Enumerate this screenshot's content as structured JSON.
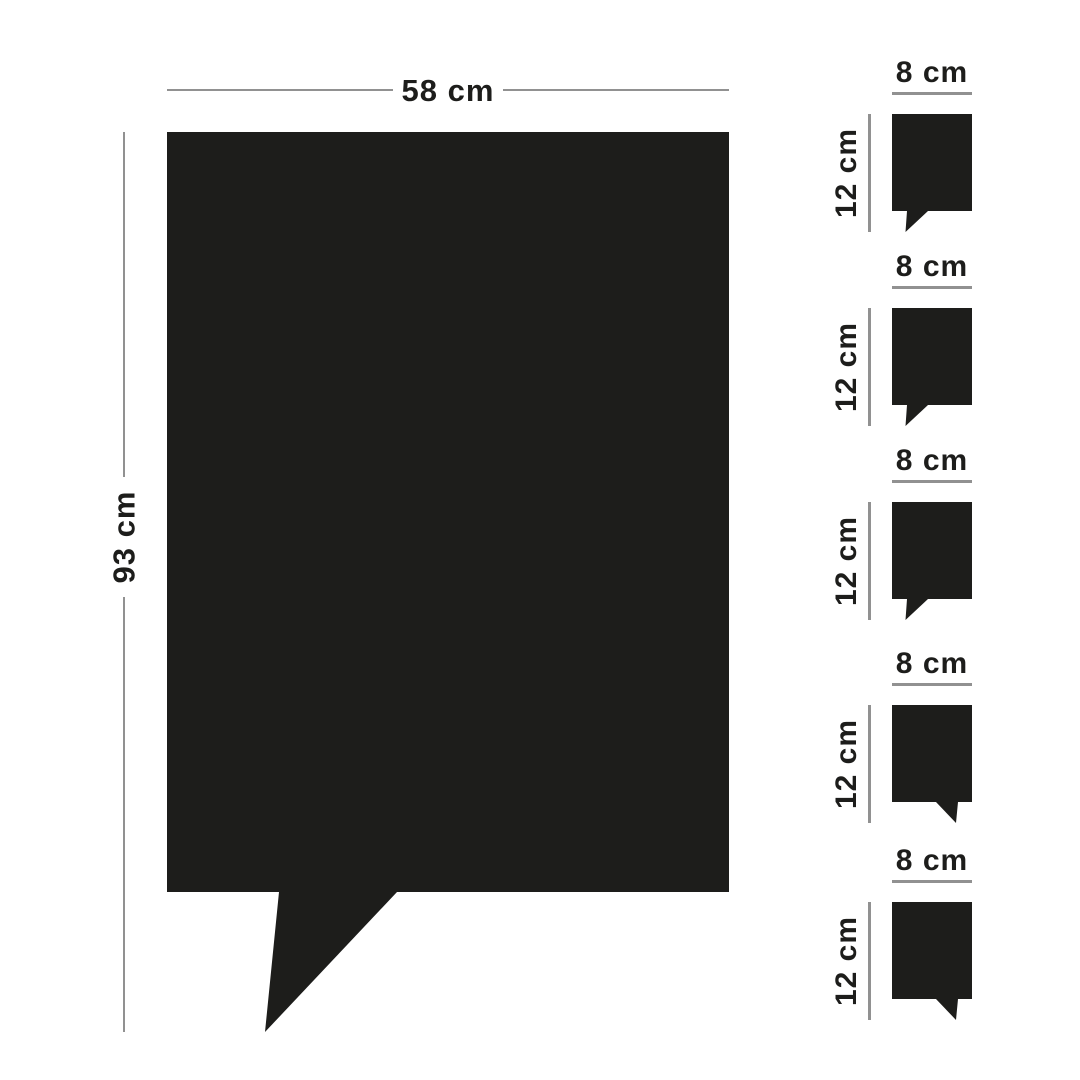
{
  "page": {
    "background": "#ffffff"
  },
  "colors": {
    "shape": "#1d1d1b",
    "text": "#1d1d1b",
    "line": "#919191"
  },
  "main_bubble": {
    "width_label": "58 cm",
    "height_label": "93 cm"
  },
  "small_bubbles": [
    {
      "width_label": "8 cm",
      "height_label": "12 cm"
    },
    {
      "width_label": "8 cm",
      "height_label": "12 cm"
    },
    {
      "width_label": "8 cm",
      "height_label": "12 cm"
    },
    {
      "width_label": "8 cm",
      "height_label": "12 cm"
    },
    {
      "width_label": "8 cm",
      "height_label": "12 cm"
    }
  ]
}
